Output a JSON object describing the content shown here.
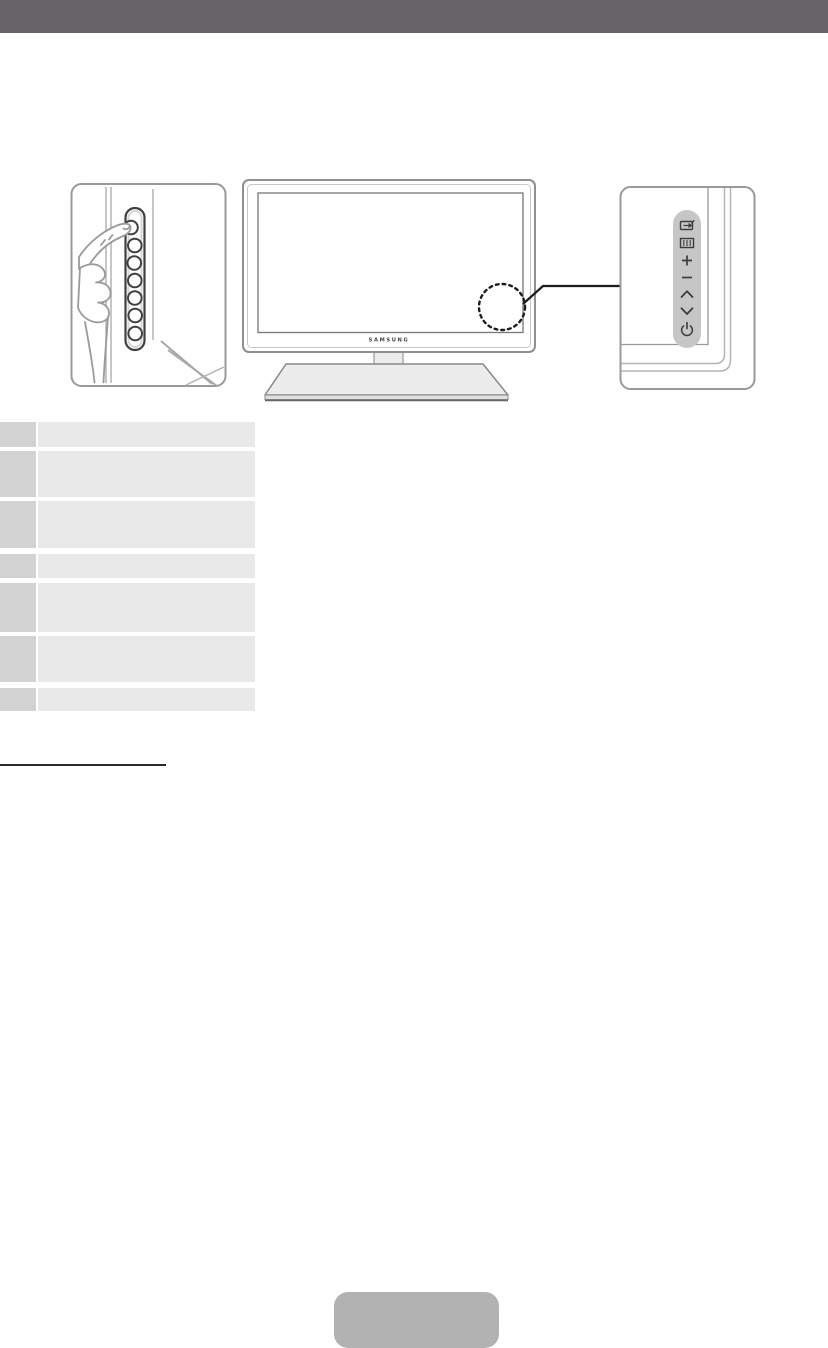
{
  "header": {
    "bar_color": "#656365"
  },
  "figure": {
    "left_card": {
      "name": "finger-pressing-side-control-panel",
      "button_count": 7
    },
    "tv": {
      "logo": "SAMSUNG"
    },
    "panel_card": {
      "strip_color": "#c6c6c6",
      "icons": [
        {
          "name": "source-icon"
        },
        {
          "name": "menu-icon"
        },
        {
          "name": "volume-up-icon",
          "glyph": "+"
        },
        {
          "name": "volume-down-icon",
          "glyph": "−"
        },
        {
          "name": "channel-up-icon",
          "glyph": "∧"
        },
        {
          "name": "channel-down-icon",
          "glyph": "∨"
        },
        {
          "name": "power-icon",
          "glyph": "⏻"
        }
      ]
    }
  },
  "table": {
    "left_cell_color": "#d2d2d2",
    "right_cell_color": "#e9e9e9",
    "rows": [
      {
        "button": "",
        "description": ""
      },
      {
        "button": "",
        "description": ""
      },
      {
        "button": "",
        "description": ""
      },
      {
        "button": "",
        "description": ""
      },
      {
        "button": "",
        "description": ""
      },
      {
        "button": "",
        "description": ""
      },
      {
        "button": "",
        "description": ""
      }
    ]
  },
  "section": {
    "heading_text": ""
  },
  "footer": {
    "button_label": "",
    "button_color": "#b2b2b2"
  }
}
